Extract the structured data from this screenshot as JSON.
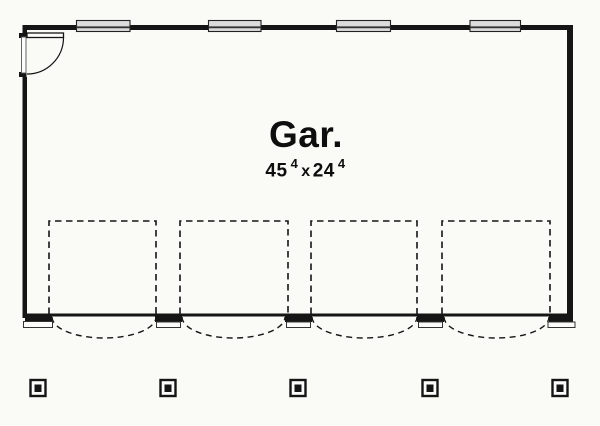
{
  "floorplan": {
    "room_label": "Gar.",
    "dimension": {
      "width_feet": "45",
      "width_inches_sup": "4",
      "separator": "x",
      "depth_feet": "24",
      "depth_inches_sup": "4"
    },
    "features": {
      "windows_count": 4,
      "garage_bays_count": 4,
      "entry_doors_count": 1,
      "posts_count": 5
    },
    "colors": {
      "line": "#151515",
      "background": "#fafaf6",
      "window_fill": "#dcdcdc"
    }
  }
}
